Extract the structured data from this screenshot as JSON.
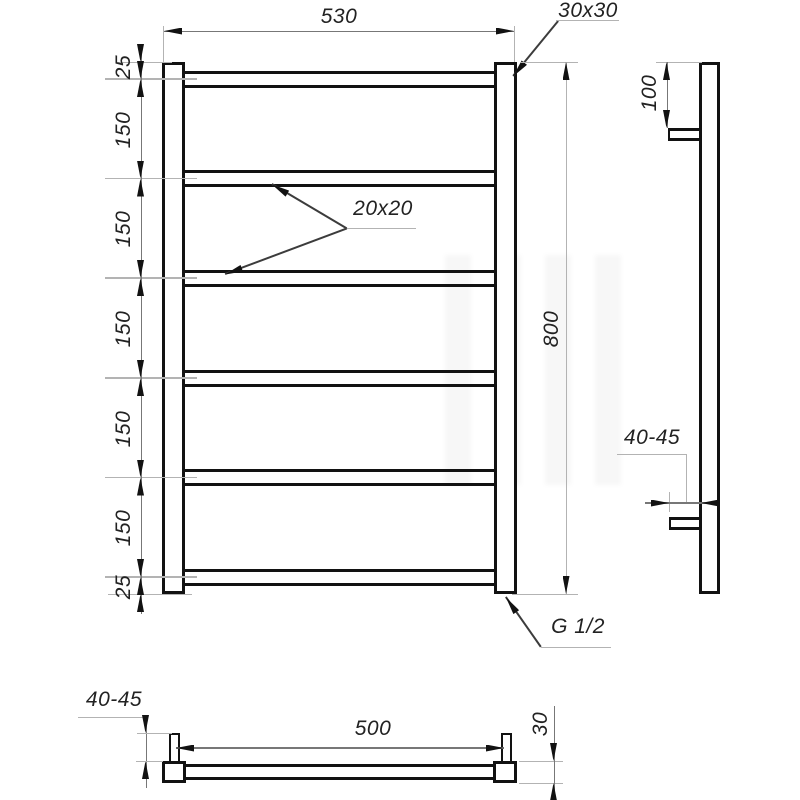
{
  "front_view": {
    "width_dim": "530",
    "corner_profile_dim": "30x30",
    "bar_profile_dim": "20x20",
    "height_dim": "800",
    "thread_dim": "G 1/2",
    "spacing_chain": [
      "25",
      "150",
      "150",
      "150",
      "150",
      "150",
      "25"
    ]
  },
  "side_view": {
    "bracket_offset_dim": "100",
    "wall_clearance_dim": "40-45"
  },
  "bottom_view": {
    "wall_clearance_dim": "40-45",
    "bracket_span_dim": "500",
    "rail_depth_dim": "30"
  },
  "colors": {
    "outline": "#121212",
    "dim_line": "#777777",
    "ext_line": "#b3b3b3",
    "background": "#ffffff"
  }
}
